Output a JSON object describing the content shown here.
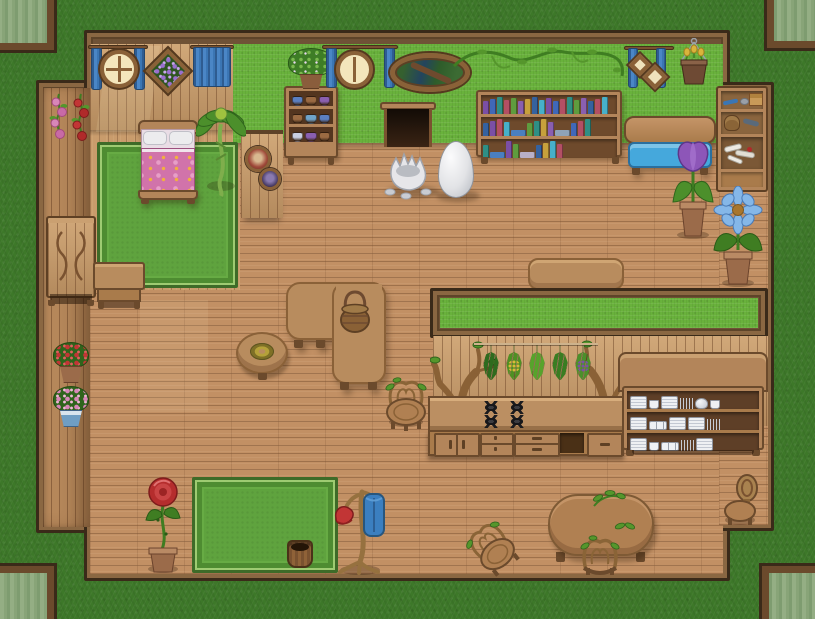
{
  "app": {
    "name": "Cozy Cottage Interior",
    "type": "top-down RPG house map screenshot",
    "viewport": "815x619"
  },
  "palette": {
    "grass_outside": "#3D7829",
    "hall_wall_green": "#69B23C",
    "floor_wood": "#C29064",
    "bedroom_wood": "#C89A68",
    "wall_cap_brown": "#6F5236",
    "trim_dark": "#3A2A19",
    "rug_green": "#5FA33E",
    "curtain_blue": "#3B76B4",
    "bench_cushion_blue": "#45A8DC",
    "bed_blanket_pink": "#D173AA",
    "terracotta_pot": "#9B6B4A",
    "egg_white": "#EDEDEF"
  },
  "exterior": {
    "ground": "grass",
    "corner_windows": [
      "top-left",
      "top-right",
      "bottom-left",
      "bottom-right"
    ]
  },
  "bedroom": {
    "items": [
      "round-window-with-blue-curtains",
      "diamond-flower-picture",
      "blue-curtain",
      "bed-with-pink-floral-blanket",
      "green-rug",
      "palm-plant",
      "round-portrait-frames"
    ]
  },
  "closet": {
    "items": [
      "pink-rose-garland",
      "red-rose-garland",
      "carved-dresser",
      "nightstand",
      "potted-red-flowers",
      "potted-pink-flowers"
    ]
  },
  "hall": {
    "items": [
      "pottery-shelf-with-plant",
      "round-window-with-blue-curtains",
      "oval-forest-mirror",
      "pet-door",
      "wall-vine",
      "bookshelf",
      "hanging-diamond-frames",
      "hanging-tulip-basket",
      "blue-cushion-bench",
      "storage-shelf-with-bones",
      "potted-purple-tulip",
      "potted-blue-flower",
      "white-egg",
      "cracked-eggshell",
      "l-shaped-table-with-basket",
      "round-side-table-with-wreath",
      "wall-side-table",
      "branch-chair",
      "green-rug",
      "potted-rose",
      "wooden-bucket",
      "coat-stand-red-hat-blue-coat",
      "oval-dining-table",
      "dining-branch-chair",
      "small-branch-chair",
      "wooden-chair"
    ],
    "bookshelf": {
      "rows": [
        [
          "#7B4FA5",
          "#4068B8",
          "#2F8F85",
          "#B34F64",
          "#5F9C3E",
          "#8A5FB0",
          "#C7A13C",
          "#35629F",
          "#47B0C9",
          "#7B4FA5",
          "#4068B8",
          "#B34F64",
          "#2F8F85",
          "#5F9C3E",
          "#8A5FB0",
          "#35629F",
          "#B34F64",
          "#47B0C9"
        ],
        [
          "#35629F",
          "#7B4FA5",
          "#B34F64",
          "#47B0C9",
          {
            "c": "#4A7FC0",
            "lay": true
          },
          "#5F9C3E",
          "#2F8F85",
          "#C7A13C",
          "#8A5FB0",
          {
            "c": "#8FA3B8",
            "lay": true
          },
          "#4068B8",
          "#B34F64",
          "#2F8F85"
        ],
        [
          "#2F8F85",
          {
            "c": "#4A7FC0",
            "lay": true
          },
          "#7B4FA5",
          "#5F9C3E",
          {
            "c": "#B8B0C8",
            "lay": true
          },
          "#35629F",
          "#C7A13C",
          "#47B0C9",
          "#B34F64"
        ]
      ]
    },
    "pottery_shelf": {
      "rows": [
        [
          "#5B7FC0",
          "#9A6A42",
          "#8A5FB0"
        ],
        [
          "#9A6A42",
          "#6FA3C9",
          "#5B7FC0"
        ],
        [
          "#C9CFE2",
          "#8A5FB0",
          "#9A6A42"
        ]
      ]
    }
  },
  "kitchen": {
    "items": [
      "grass-topped-partition-wall",
      "branch-tree-decor-left",
      "branch-tree-decor-right",
      "hanging-herb-line",
      "stove-burners",
      "cabinet-counter",
      "dish-hutch"
    ],
    "herb_bundles": [
      {
        "leaf": "#2E6B1E"
      },
      {
        "leaf": "#4F8F23",
        "accent": "#D8B83A"
      },
      {
        "leaf": "#57A32C"
      },
      {
        "leaf": "#3A7D22"
      },
      {
        "leaf": "#4C8F2B",
        "accent": "#7B4FA5"
      }
    ],
    "hutch": {
      "rows": [
        [
          "plates",
          "cup",
          "plates",
          "cutlery",
          "pot",
          "cup"
        ],
        [
          "plates",
          "cups",
          "plates",
          "plates",
          "cutlery"
        ],
        [
          "plates",
          "cup",
          "cups",
          "cutlery",
          "plates"
        ]
      ]
    },
    "burner_count": 4
  }
}
